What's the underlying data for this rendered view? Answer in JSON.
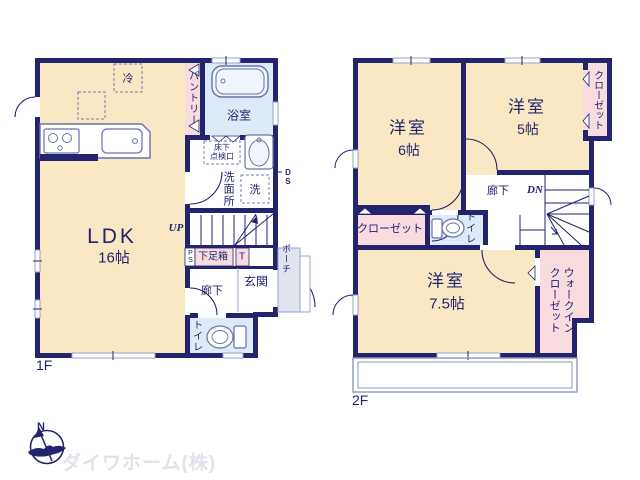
{
  "floor1": {
    "label": "1F",
    "ldk": {
      "name": "LDK",
      "size": "16帖"
    },
    "fridge": "冷",
    "pantry": "パントリー",
    "bathroom": "浴室",
    "underfloor_line1": "床下",
    "underfloor_line2": "点検口",
    "washroom": "洗面所",
    "washer": "洗",
    "duct": "DS",
    "stairs_up": "UP",
    "pipe_space": "PS",
    "shoe_box": "下足箱",
    "shoe_box_t": "T",
    "hallway": "廊下",
    "entrance": "玄関",
    "porch": "ポーチ",
    "toilet": "トイレ"
  },
  "floor2": {
    "label": "2F",
    "bedroom6": {
      "name": "洋室",
      "size": "6帖"
    },
    "bedroom5": {
      "name": "洋室",
      "size": "5帖"
    },
    "bedroom7_5": {
      "name": "洋室",
      "size": "7.5帖"
    },
    "closet_top": "クローゼット",
    "closet_bottom": "クローゼット",
    "walkin_line1": "ウォークイン",
    "walkin_line2": "クローゼット",
    "toilet": "トイレ",
    "hallway": "廊下",
    "stairs_down": "DN"
  },
  "footer": {
    "compass_north": "N",
    "company": "ダイワホーム(株)"
  },
  "colors": {
    "wall": "#23236e",
    "room_beige": "#f9e8c4",
    "closet_pink": "#f9dcdf",
    "wet_blue": "#dcebf7",
    "text": "#23236e"
  }
}
